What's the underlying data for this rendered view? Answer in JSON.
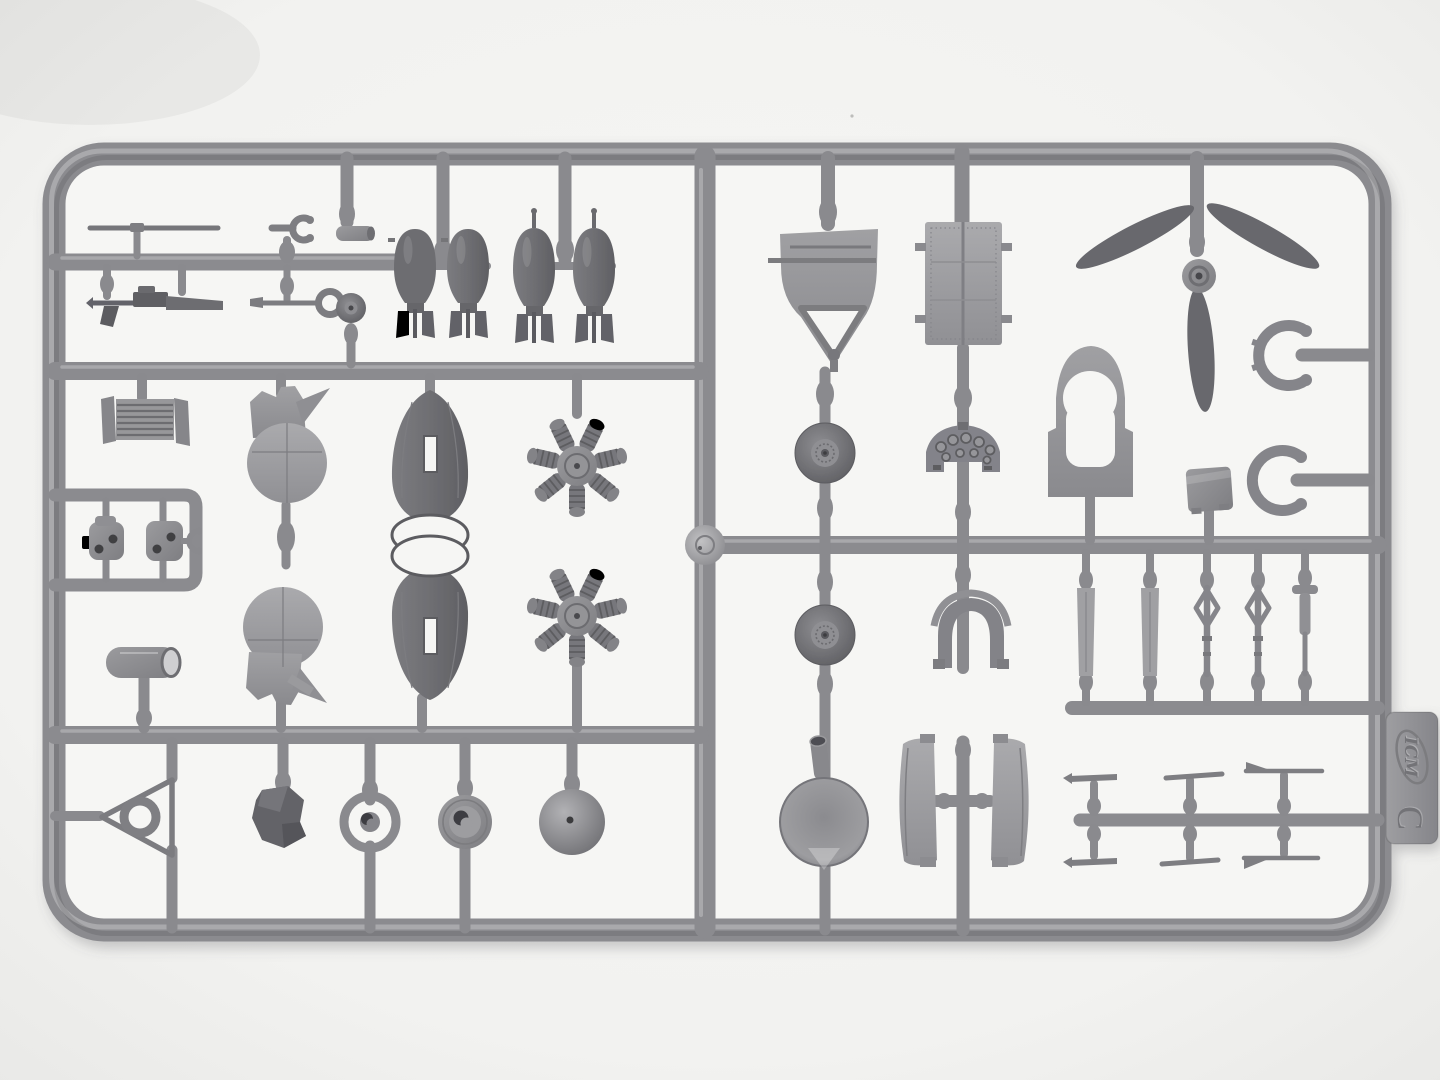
{
  "image": {
    "type": "photograph",
    "subject": "Injection-molded plastic model kit sprue on a white background"
  },
  "sprue": {
    "brand": "ICM",
    "letter": "C",
    "plastic_color": "#8d8d90",
    "plastic_dark": "#6d6d71",
    "plastic_light": "#a5a5a8",
    "background_color": "#f2f2f0",
    "pocket_color": "#f6f6f4",
    "shadow_color": "#5a5a60"
  },
  "tab": {
    "brand_logo": "ICM",
    "letter": "C"
  },
  "parts": [
    "antenna rod",
    "machine gun",
    "fork clevis",
    "small cylinder",
    "eye-bolt rod",
    "tail wheel",
    "bomb pair A (two bombs, box tail fins)",
    "bomb pair B (two bombs, nose fuze spikes)",
    "shield-shaped bulkhead with hinge triangle",
    "riveted access panel with side stubs",
    "three-blade propeller",
    "exhaust collector arc (upper)",
    "exhaust collector arc (lower)",
    "keyhole bulkhead frame",
    "headrest box",
    "radiator core with end plates",
    "fuselage side section (upper)",
    "fuselage side section (lower)",
    "engine cowling half (upper)",
    "engine cowling half (lower)",
    "seven-cylinder radial engine row (front)",
    "seven-cylinder radial engine row (rear)",
    "engine mount bracket A",
    "engine mount bracket B with clevis",
    "tail cone cylinder",
    "tail wheel yoke triangle with ring",
    "irregular seat cushion",
    "wheel hub ring A",
    "wheel hub ring B",
    "propeller spinner dome",
    "fuel tank end disc with filler pipe",
    "main wheel (upper)",
    "main wheel (lower)",
    "instrument panel with gauges",
    "headrest arch",
    "cowl flap panel (left)",
    "cowl flap panel (right)",
    "flat strut blade x2",
    "landing gear leg x2",
    "oleo strut with cap",
    "small rod and horn parts x6"
  ]
}
